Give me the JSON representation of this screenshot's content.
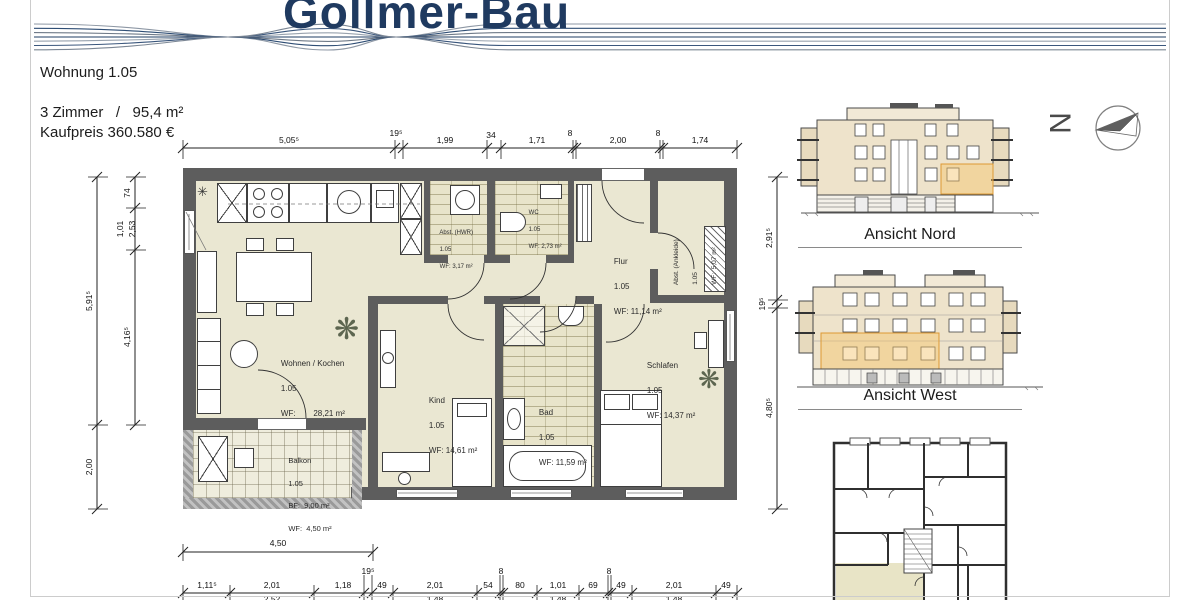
{
  "brand": "Gollmer-Bau",
  "info": {
    "apartment": "Wohnung 1.05",
    "rooms": "3 Zimmer   /   95,4 m²",
    "price": "Kaufpreis 360.580 €"
  },
  "rooms": {
    "wohnen": {
      "name": "Wohnen / Kochen",
      "unit": "1.05",
      "area": "WF:        28,21 m²"
    },
    "kind": {
      "name": "Kind",
      "unit": "1.05",
      "area": "WF: 14,61 m²"
    },
    "bad": {
      "name": "Bad",
      "unit": "1.05",
      "area": "WF: 11,59 m²"
    },
    "schlafen": {
      "name": "Schlafen",
      "unit": "1.05",
      "area": "WF: 14,37 m²"
    },
    "flur": {
      "name": "Flur",
      "unit": "1.05",
      "area": "WF: 11,14 m²"
    },
    "ankleide": {
      "name": "Abst. (Ankleide)",
      "unit": "1.05",
      "area": "WF:  5,07 m²"
    },
    "hwr": {
      "name": "Abst. (HWR)",
      "unit": "1.05",
      "area": "WF: 3,17 m²"
    },
    "wc": {
      "name": "WC",
      "unit": "1.05",
      "area": "WF: 2,73 m²"
    },
    "balkon": {
      "name": "Balkon",
      "unit": "1.05",
      "bf": "BF:  9,00 m²",
      "wf": "WF:  4,50 m²"
    }
  },
  "dims": {
    "top": [
      "5,05⁵",
      "19⁵",
      "1,99",
      "34",
      "1,71",
      "8",
      "2,00",
      "8",
      "1,74"
    ],
    "left_outer": [
      "5,91⁵",
      "2,00"
    ],
    "left_inner": [
      "74",
      "1,01",
      "2,53",
      "4,16⁵"
    ],
    "right": [
      "2,91⁵",
      "19⁵",
      "4,80⁵"
    ],
    "balcony_width": "4,50",
    "bottom": [
      "1,11⁵",
      "2,01",
      "1,18",
      "19⁵",
      "49",
      "2,01",
      "54",
      "8",
      "80",
      "1,01",
      "69",
      "8",
      "49",
      "2,01",
      "49"
    ],
    "bottom_row2": [
      "2,52",
      "1,48",
      "1,48",
      "1,48"
    ]
  },
  "elevations": {
    "nord": "Ansicht Nord",
    "west": "Ansicht West"
  },
  "compass": {
    "letter": "N"
  },
  "colors": {
    "brand_navy": "#1f3a60",
    "wall_gray": "#5d5d5d",
    "floor_beige": "#eae7d2",
    "highlight_orange": "#dd9933"
  }
}
